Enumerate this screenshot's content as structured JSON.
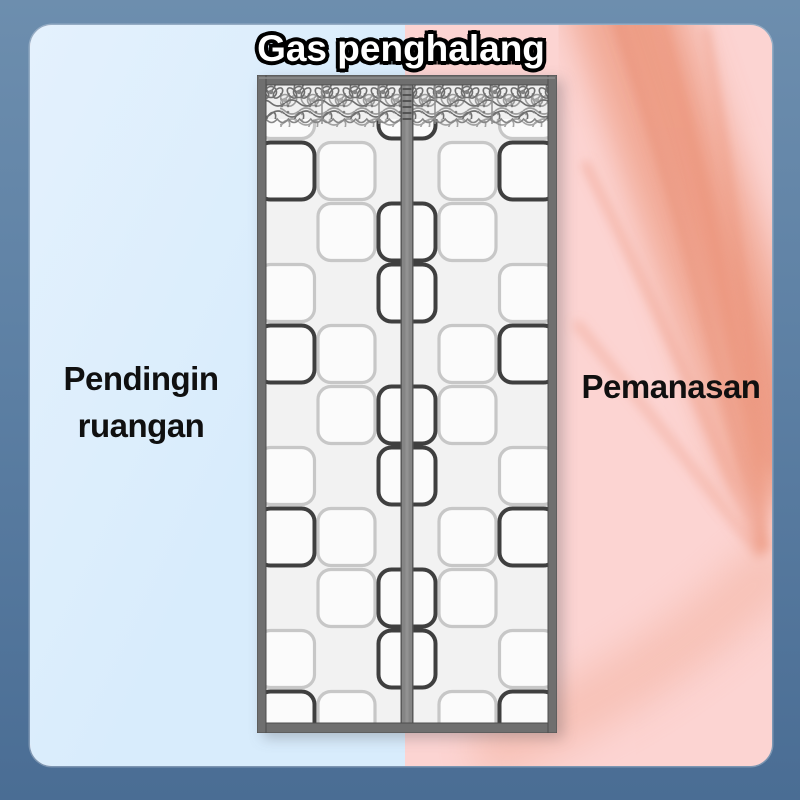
{
  "title": "Gas penghalang",
  "labels": {
    "cool_line1": "Pendingin",
    "cool_line2": "ruangan",
    "warm": "Pemanasan"
  },
  "colors": {
    "outer_background": "#5d80a4",
    "cool_side": "#d8ecfc",
    "warm_side": "#fcd4d2",
    "heat_wave_main": "#efa28b",
    "heat_wave_deep": "#e98f74",
    "heat_wave_streak": "#ea9278",
    "heat_wave_soft": "#f2ad99",
    "curtain_frame": "#6f6f6f",
    "curtain_frame_edge": "#4e4e4e",
    "mesh_background": "#f2f2f2",
    "square_fill": "#fbfbfb",
    "square_dark": "#3f3f3f",
    "square_light": "#c7c7c7",
    "magnet_strip": "#858585",
    "magnet_strip_edge": "#565656",
    "lace_gray": "#757575",
    "title_text": "#ffffff",
    "title_outline": "#000000",
    "label_text": "#101010"
  }
}
